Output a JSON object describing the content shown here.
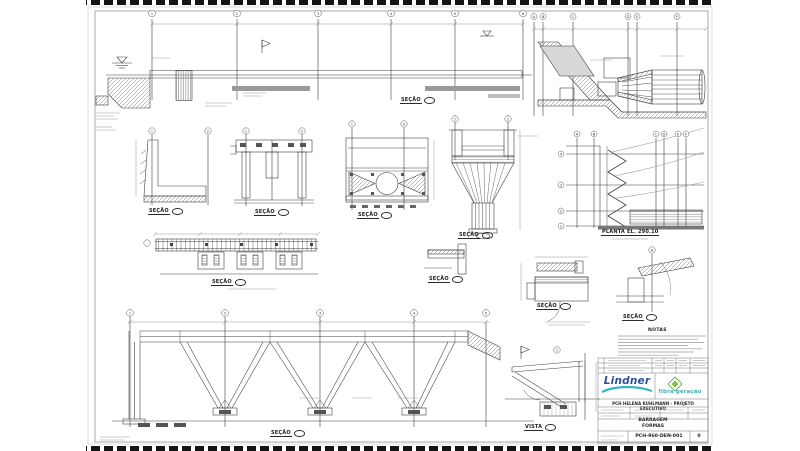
{
  "labels": [
    {
      "text": "SEÇÃO"
    },
    {
      "text": "SEÇÃO"
    },
    {
      "text": "SEÇÃO"
    },
    {
      "text": "SEÇÃO"
    },
    {
      "text": "SEÇÃO"
    },
    {
      "text": "PLANTA  EL. 290.10"
    },
    {
      "text": "SEÇÃO"
    },
    {
      "text": "SEÇÃO"
    },
    {
      "text": "SEÇÃO"
    },
    {
      "text": "SEÇÃO"
    },
    {
      "text": "SEÇÃO"
    },
    {
      "text": "VISTA"
    },
    {
      "text": "NOTAS"
    }
  ],
  "grid": {
    "elev_top": [
      "1",
      "2",
      "3",
      "4",
      "5",
      "6"
    ],
    "intake_top": [
      "A",
      "B",
      "C",
      "D",
      "E",
      "F"
    ],
    "plan_letters": [
      "A",
      "B",
      "C",
      "D",
      "E",
      "F"
    ],
    "plan_numbers": [
      "4",
      "3",
      "2",
      "1"
    ],
    "truss_top": [
      "1",
      "2",
      "3",
      "4",
      "5"
    ],
    "detail_bubbles": [
      "1",
      "2",
      "1",
      "2",
      "1",
      "2",
      "1",
      "2",
      "1",
      "A"
    ]
  },
  "title_block": {
    "company": "Lindner",
    "brand": "fibra geração",
    "project": "PCH HELENA KUHLMANN - PROJETO EXECUTIVO",
    "area": "BARRAGEM",
    "subject": "FORMAS",
    "drawing_number": "PCH-960-DEN-001",
    "revision": "0"
  },
  "colors": {
    "line": "#3f3f3f",
    "company_blue": "#2b4fa0",
    "brand_teal": "#3fb0b4",
    "brand_green": "#7fc241"
  }
}
